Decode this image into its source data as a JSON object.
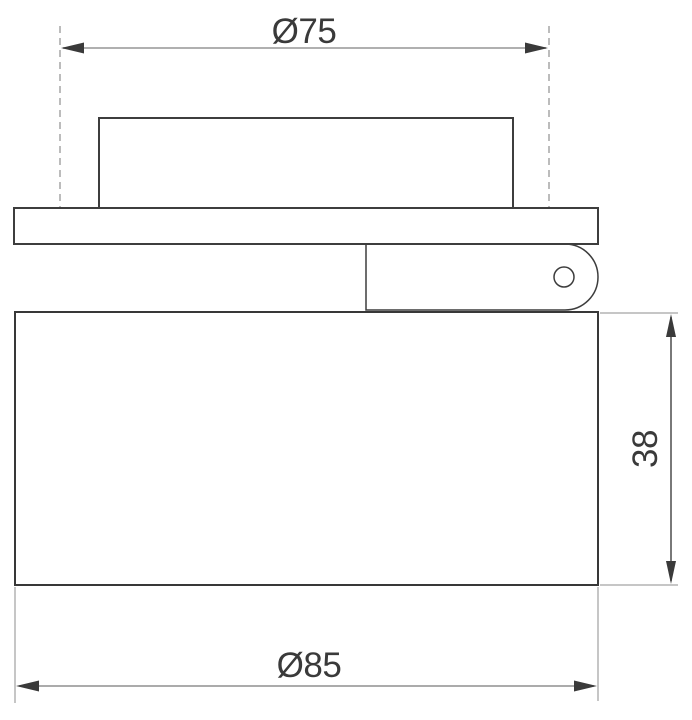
{
  "drawing": {
    "dimension_labels": {
      "top_diameter": "Ø75",
      "height": "38",
      "bottom_diameter": "Ø85"
    },
    "dimension_values": {
      "top_diameter_mm": 75,
      "height_mm": 38,
      "bottom_diameter_mm": 85
    },
    "colors": {
      "background": "#ffffff",
      "outline": "#3d3d3d",
      "dimension_text": "#3a3a3a",
      "arrowhead": "#3a3a3a",
      "dimension_line": "#9c9c9c",
      "extension_line": "#b3b3b3"
    }
  }
}
